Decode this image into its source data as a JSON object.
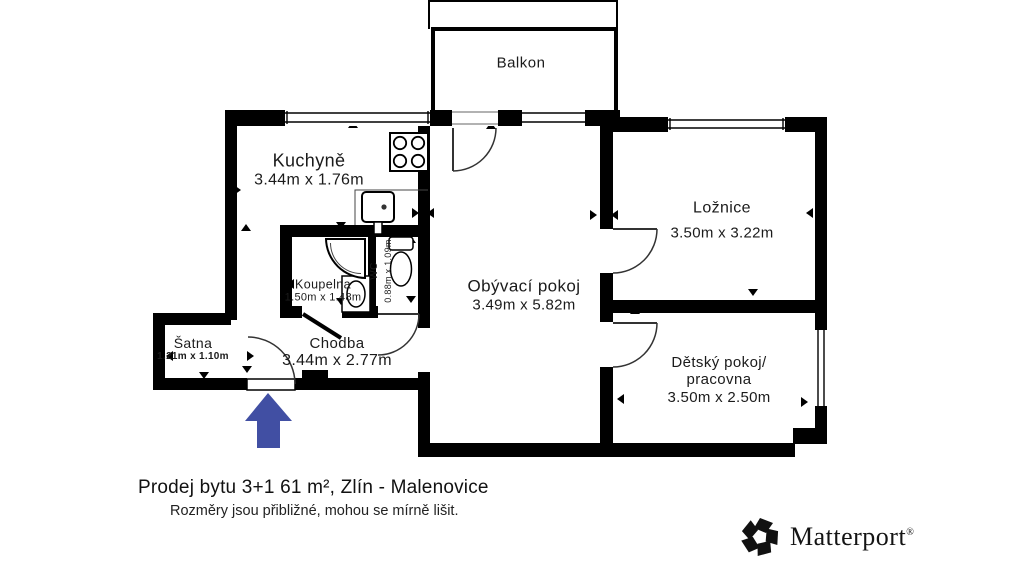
{
  "floor_plan": {
    "balcony_label": "Balkon",
    "rooms": {
      "kuchyne": {
        "name": "Kuchyně",
        "dims": "3.44m x 1.76m"
      },
      "obyvaci": {
        "name": "Obývací pokoj",
        "dims": "3.49m x 5.82m"
      },
      "loznice": {
        "name": "Ložnice",
        "dims": "3.50m x 3.22m"
      },
      "detsky": {
        "name_line1": "Dětský pokoj/",
        "name_line2": "pracovna",
        "dims": "3.50m x 2.50m"
      },
      "koupelna": {
        "name": "Koupelna",
        "dims": "1.50m x 1.48m"
      },
      "wc": {
        "name": "WC",
        "dims": "0.88m  x 1.09m"
      },
      "satna": {
        "name": "Šatna",
        "dims": "1.21m x 1.10m"
      },
      "chodba": {
        "name": "Chodba",
        "dims": "3.44m x 2.77m"
      }
    },
    "entrance_arrow": "entrance-direction-up"
  },
  "footer": {
    "title": "Prodej bytu 3+1 61 m², Zlín - Malenovice",
    "subtitle": "Rozměry jsou přibližné, mohou se mírně lišit.",
    "brand": "Matterport",
    "brand_reg": "®"
  },
  "colors": {
    "wall": "#000000",
    "background": "#ffffff",
    "entrance_arrow": "#414fa3"
  }
}
